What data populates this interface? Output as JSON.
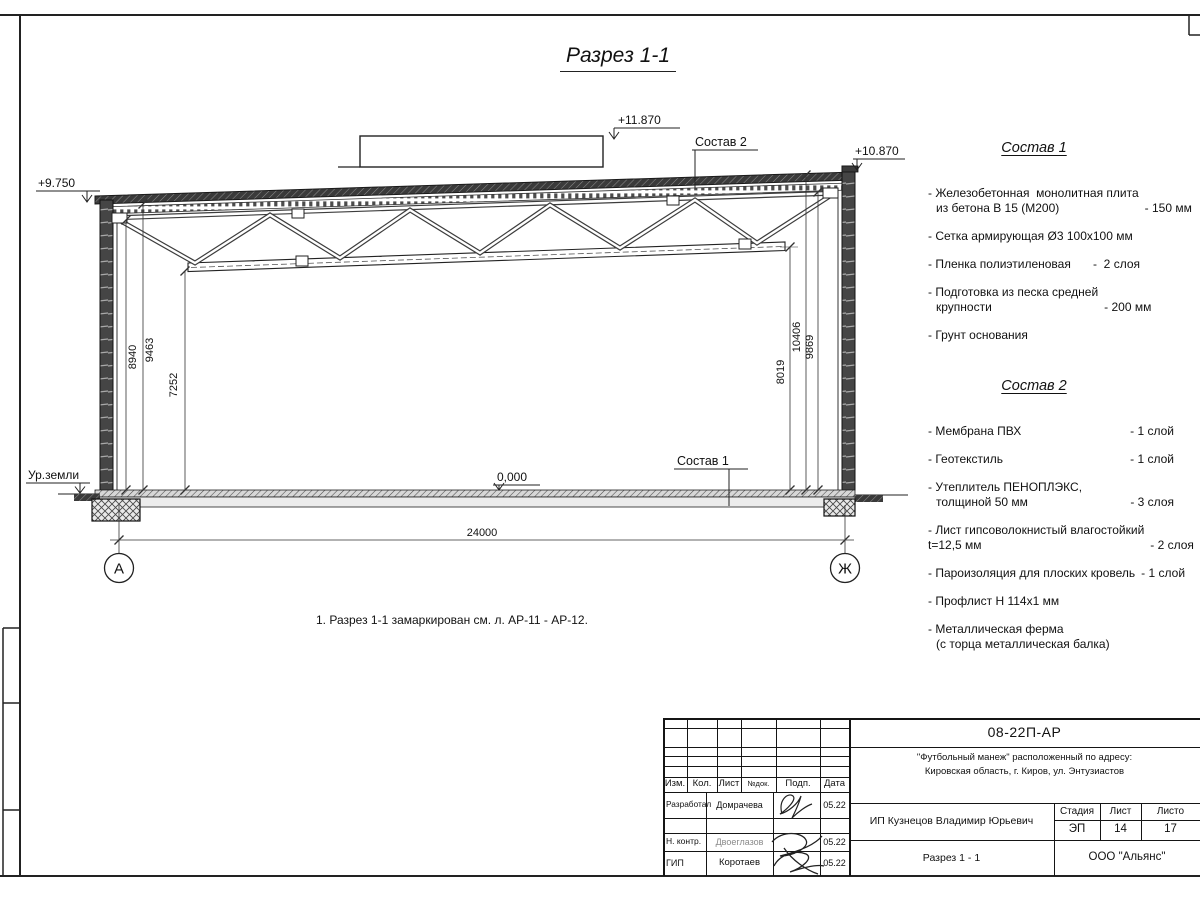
{
  "drawing": {
    "title": "Разрез 1-1",
    "note": "1. Разрез 1-1 замаркирован см. л. АР-11 - АР-12.",
    "elev_left": "+9.750",
    "elev_box": "+11.870",
    "elev_right": "+10.870",
    "elev_floor": "0,000",
    "ground_label": "Ур.земли",
    "layer1_label": "Состав 1",
    "layer2_label": "Состав 2",
    "dim_span": "24000",
    "dims_left": [
      "8940",
      "9463",
      "7252"
    ],
    "dims_right": [
      "8019",
      "10406",
      "9869"
    ],
    "axis_left": "А",
    "axis_right": "Ж"
  },
  "sostav1": {
    "title": "Состав 1",
    "items": [
      {
        "line1": "- Железобетонная  монолитная плита",
        "line2": "из бетона В 15 (М200)",
        "value": "- 150 мм"
      },
      {
        "line1": "- Сетка армирующая Ø3 100х100 мм",
        "line2": "",
        "value": ""
      },
      {
        "line1": "- Пленка полиэтиленовая",
        "line2": "",
        "value": "-  2 слоя"
      },
      {
        "line1": "- Подготовка из песка средней",
        "line2": "крупности",
        "value": "- 200 мм"
      },
      {
        "line1": "- Грунт основания",
        "line2": "",
        "value": ""
      }
    ]
  },
  "sostav2": {
    "title": "Состав 2",
    "items": [
      {
        "line1": "- Мембрана ПВХ",
        "line2": "",
        "value": "- 1 слой"
      },
      {
        "line1": "- Геотекстиль",
        "line2": "",
        "value": "- 1 слой"
      },
      {
        "line1": "- Утеплитель ПЕНОПЛЭКС,",
        "line2": "толщиной 50 мм",
        "value": "- 3 слоя"
      },
      {
        "line1": "- Лист гипсоволокнистый влагостойкий",
        "line2": "t=12,5 мм",
        "value": "- 2 слоя"
      },
      {
        "line1": "- Пароизоляция для плоских кровель",
        "line2": "",
        "value": "- 1 слой"
      },
      {
        "line1": "- Профлист Н 114х1 мм",
        "line2": "",
        "value": ""
      },
      {
        "line1": "- Металлическая ферма",
        "line2": "(с торца металлическая балка)",
        "value": ""
      }
    ]
  },
  "titleblock": {
    "doc_number": "08-22П-АР",
    "object_line1": "\"Футбольный манеж\" расположенный по адресу:",
    "object_line2": "Кировская область, г. Киров, ул. Энтузиастов",
    "col_izm": "Изм.",
    "col_kol": "Кол.",
    "col_list": "Лист",
    "col_doc": "№док.",
    "col_podp": "Подп.",
    "col_data": "Дата",
    "row1_role": "Разработал",
    "row1_name": "Домрачева",
    "row1_date": "05.22",
    "row2_role": "Н. контр.",
    "row2_name": "Двоеглазов",
    "row2_date": "05.22",
    "row3_role": "ГИП",
    "row3_name": "Коротаев",
    "row3_date": "05.22",
    "client": "ИП Кузнецов Владимир Юрьевич",
    "sheet_name": "Разрез 1 - 1",
    "stage_label": "Стадия",
    "list_label": "Лист",
    "listov_label": "Листо",
    "stage": "ЭП",
    "sheet_num": "14",
    "sheets_total": "17",
    "company": "ООО \"Альянс\""
  }
}
